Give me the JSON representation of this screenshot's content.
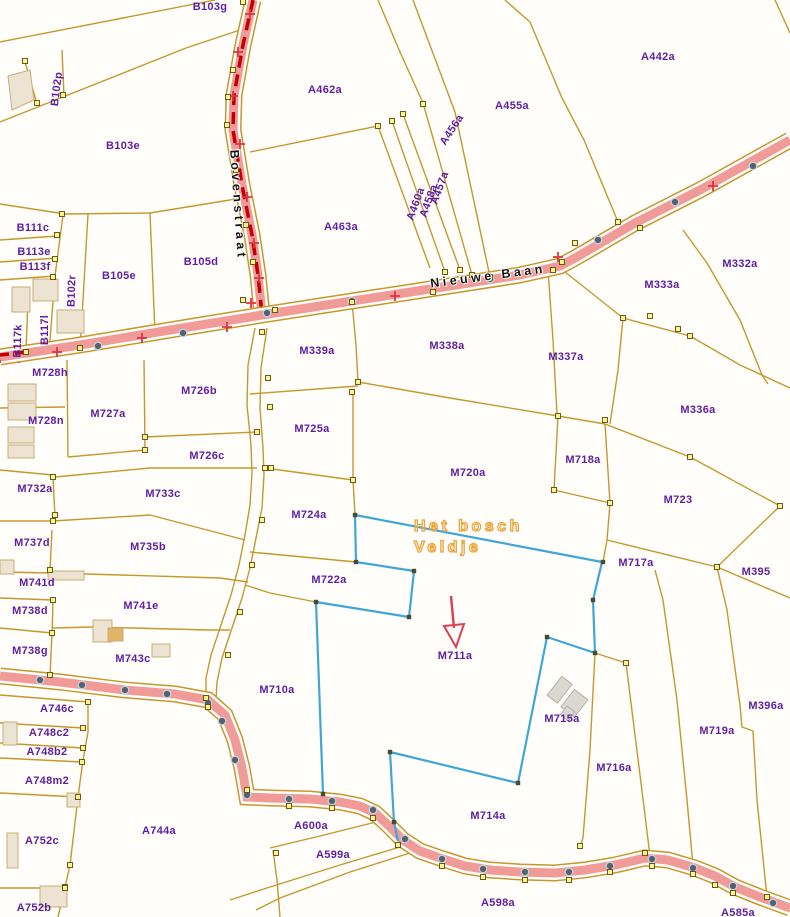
{
  "streets": [
    {
      "name": "Bovenstraat"
    },
    {
      "name": "Nieuwe Baan"
    }
  ],
  "area_label": {
    "line1": "Het bosch",
    "line2": "Veldje"
  },
  "arrow_target": "M711a",
  "parcels": [
    {
      "id": "B103g",
      "x": 210,
      "y": 7
    },
    {
      "id": "B102p",
      "x": 57,
      "y": 89,
      "rot": -83
    },
    {
      "id": "B103e",
      "x": 123,
      "y": 146
    },
    {
      "id": "A462a",
      "x": 325,
      "y": 90
    },
    {
      "id": "A455a",
      "x": 512,
      "y": 106
    },
    {
      "id": "A442a",
      "x": 658,
      "y": 57
    },
    {
      "id": "A456a",
      "x": 452,
      "y": 130,
      "rot": -57
    },
    {
      "id": "A457a",
      "x": 440,
      "y": 188,
      "rot": -70
    },
    {
      "id": "A458a",
      "x": 429,
      "y": 201,
      "rot": -70
    },
    {
      "id": "A460a",
      "x": 416,
      "y": 204,
      "rot": -70
    },
    {
      "id": "A463a",
      "x": 341,
      "y": 227
    },
    {
      "id": "B111c",
      "x": 33,
      "y": 228
    },
    {
      "id": "B113e",
      "x": 34,
      "y": 252
    },
    {
      "id": "B113f",
      "x": 35,
      "y": 267
    },
    {
      "id": "B105e",
      "x": 119,
      "y": 276
    },
    {
      "id": "B105d",
      "x": 201,
      "y": 262
    },
    {
      "id": "B102r",
      "x": 72,
      "y": 291,
      "rot": -88
    },
    {
      "id": "B117l",
      "x": 45,
      "y": 330,
      "rot": -90
    },
    {
      "id": "B117k",
      "x": 18,
      "y": 341,
      "rot": -88
    },
    {
      "id": "M728h",
      "x": 50,
      "y": 373
    },
    {
      "id": "M332a",
      "x": 740,
      "y": 264
    },
    {
      "id": "M333a",
      "x": 662,
      "y": 285
    },
    {
      "id": "M337a",
      "x": 566,
      "y": 357
    },
    {
      "id": "M338a",
      "x": 447,
      "y": 346
    },
    {
      "id": "M339a",
      "x": 317,
      "y": 351
    },
    {
      "id": "M336a",
      "x": 698,
      "y": 410
    },
    {
      "id": "M726b",
      "x": 199,
      "y": 391
    },
    {
      "id": "M727a",
      "x": 108,
      "y": 414
    },
    {
      "id": "M728n",
      "x": 46,
      "y": 421
    },
    {
      "id": "M725a",
      "x": 312,
      "y": 429
    },
    {
      "id": "M726c",
      "x": 207,
      "y": 456
    },
    {
      "id": "M720a",
      "x": 468,
      "y": 473
    },
    {
      "id": "M718a",
      "x": 583,
      "y": 460
    },
    {
      "id": "M732a",
      "x": 35,
      "y": 489
    },
    {
      "id": "M733c",
      "x": 163,
      "y": 494
    },
    {
      "id": "M723",
      "x": 678,
      "y": 500
    },
    {
      "id": "M724a",
      "x": 309,
      "y": 515
    },
    {
      "id": "M737d",
      "x": 32,
      "y": 543
    },
    {
      "id": "M735b",
      "x": 148,
      "y": 547
    },
    {
      "id": "M717a",
      "x": 636,
      "y": 563
    },
    {
      "id": "M741d",
      "x": 37,
      "y": 583
    },
    {
      "id": "M395",
      "x": 756,
      "y": 572
    },
    {
      "id": "M722a",
      "x": 329,
      "y": 580
    },
    {
      "id": "M738d",
      "x": 30,
      "y": 611
    },
    {
      "id": "M741e",
      "x": 141,
      "y": 606
    },
    {
      "id": "M711a",
      "x": 455,
      "y": 656
    },
    {
      "id": "M738g",
      "x": 30,
      "y": 651
    },
    {
      "id": "M743c",
      "x": 133,
      "y": 659
    },
    {
      "id": "M710a",
      "x": 277,
      "y": 690
    },
    {
      "id": "A746c",
      "x": 57,
      "y": 709
    },
    {
      "id": "M715a",
      "x": 562,
      "y": 719
    },
    {
      "id": "A748c2",
      "x": 49,
      "y": 733
    },
    {
      "id": "M396a",
      "x": 766,
      "y": 706
    },
    {
      "id": "A748b2",
      "x": 47,
      "y": 752
    },
    {
      "id": "M719a",
      "x": 717,
      "y": 731
    },
    {
      "id": "A748m2",
      "x": 47,
      "y": 781
    },
    {
      "id": "M716a",
      "x": 614,
      "y": 768
    },
    {
      "id": "A752c",
      "x": 42,
      "y": 841
    },
    {
      "id": "A744a",
      "x": 159,
      "y": 831
    },
    {
      "id": "A600a",
      "x": 311,
      "y": 826
    },
    {
      "id": "A599a",
      "x": 333,
      "y": 855
    },
    {
      "id": "M714a",
      "x": 488,
      "y": 816
    },
    {
      "id": "A598a",
      "x": 498,
      "y": 903
    },
    {
      "id": "A752b",
      "x": 34,
      "y": 908
    },
    {
      "id": "A585a",
      "x": 738,
      "y": 913
    }
  ],
  "colors": {
    "parcel_line": "#c6982c",
    "parcel_label": "#5e1ea0",
    "road_fill": "#f09b98",
    "road_dash": "#bf0000",
    "plus_mark": "#e03440",
    "road_dot": "#55616c",
    "highlight_outline": "#3ea7d8",
    "area_text": "#eaa43c",
    "arrow": "#e13c52",
    "building_fill": "#ece3d2",
    "vertex_marker": "#fdf58a"
  }
}
